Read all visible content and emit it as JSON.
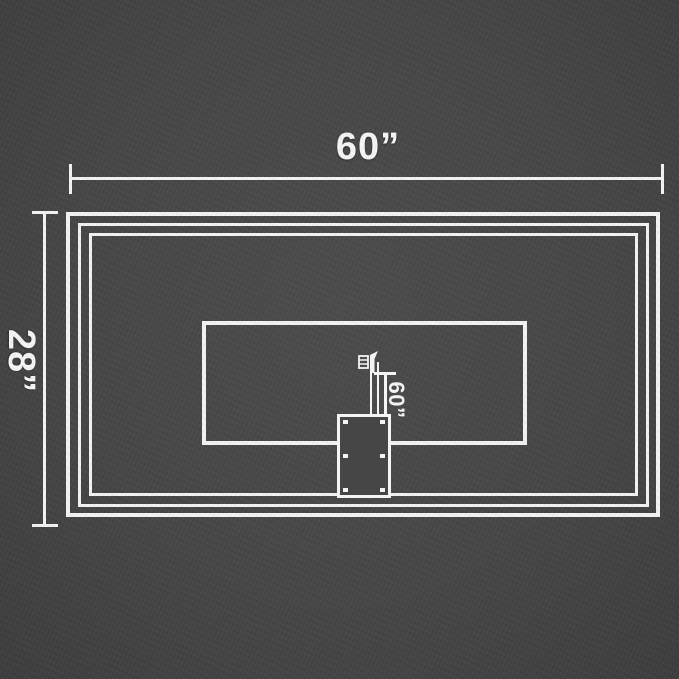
{
  "page": {
    "type": "product-dimension-diagram",
    "background_color": "#464646",
    "line_color": "#f4f4f4"
  },
  "labels": {
    "board_width": "60”",
    "board_height": "28”",
    "pole_height": "60”"
  },
  "icons": {
    "mount_hook": "mount-hook-icon"
  }
}
